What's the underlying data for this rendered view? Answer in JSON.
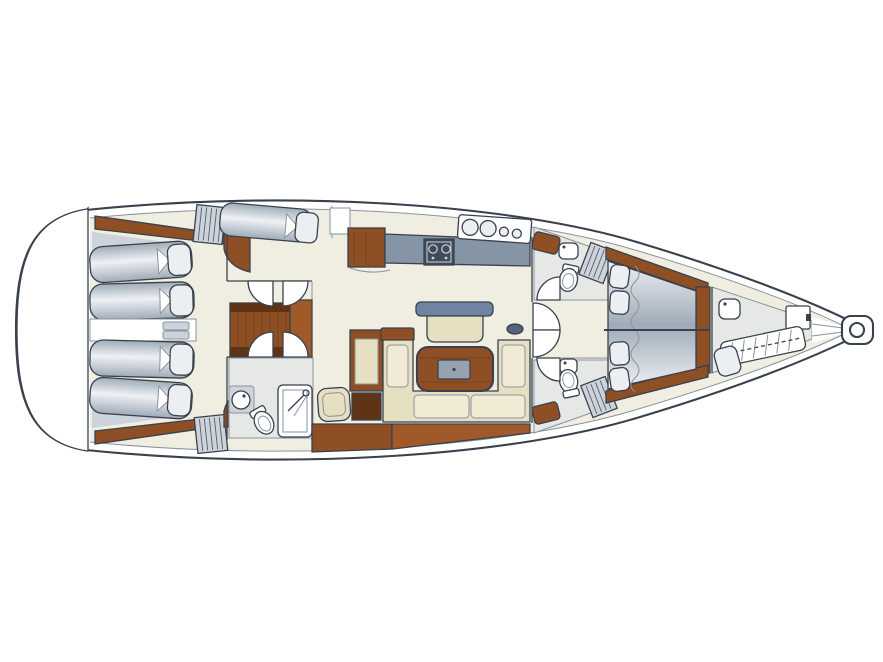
{
  "diagram": {
    "type": "boat-floor-plan",
    "subject": "sailing-yacht-interior-layout",
    "orientation": "bow-right",
    "background": "#ffffff"
  },
  "colors": {
    "line": "#39414e",
    "line_soft": "#8a93a0",
    "white": "#ffffff",
    "floor_cream": "#f0eee1",
    "floor_gray": "#e6e8e6",
    "panel_gray": "#ccd3da",
    "wood": "#8e4f25",
    "wood_mid": "#a05a2a",
    "wood_dark": "#5f3315",
    "berth_hi": "#eef1f4",
    "berth_lo": "#9fabb7",
    "pillow": "#eceff2",
    "counter": "#8695a6",
    "stove": "#3f4b5a",
    "steel_blue": "#7183a2",
    "beige": "#e7dfc2",
    "beige_light": "#f1ebd5",
    "beige_dark": "#d6caa5",
    "table_inset": "#96a2ad",
    "handle": "#54637a"
  },
  "areas": [
    {
      "id": "hull",
      "label": "Yacht hull outline, bow pointing right"
    },
    {
      "id": "transom-platform",
      "label": "Stern transom swim platform"
    },
    {
      "id": "aft-cabin-port",
      "label": "Aft port cabin with double berth"
    },
    {
      "id": "aft-cabin-starboard",
      "label": "Aft starboard cabin with double berth"
    },
    {
      "id": "companionway-stairs",
      "label": "Companionway stairs"
    },
    {
      "id": "aft-head",
      "label": "Aft head with shower, sink and toilet"
    },
    {
      "id": "nav-station",
      "label": "Navigation station with seat and chart table"
    },
    {
      "id": "galley",
      "label": "Galley with stove, sinks and counters"
    },
    {
      "id": "side-berth",
      "label": "Single side berth beside galley"
    },
    {
      "id": "salon",
      "label": "Salon with U-shaped settee, table and bench"
    },
    {
      "id": "head-forward-port",
      "label": "Forward port head with toilet and sink"
    },
    {
      "id": "head-forward-starboard",
      "label": "Forward starboard head with toilet and sink"
    },
    {
      "id": "owner-cabin",
      "label": "Owner cabin with island double berth"
    },
    {
      "id": "bow-cabin",
      "label": "Bow crew cabin with single berth and sink"
    },
    {
      "id": "anchor-locker",
      "label": "Anchor locker and bow fitting"
    }
  ]
}
